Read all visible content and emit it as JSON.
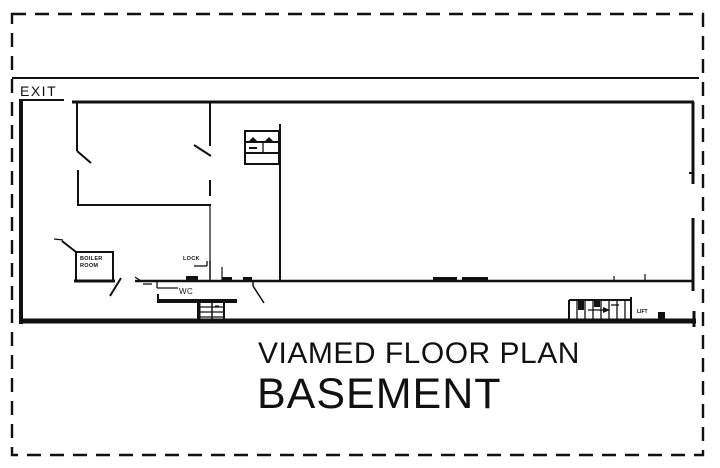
{
  "page": {
    "background": "#ffffff",
    "ink": "#111111"
  },
  "plan": {
    "exit_label": "EXIT",
    "boiler_room_label_line1": "BOILER",
    "boiler_room_label_line2": "ROOM",
    "lock_label": "LOCK",
    "wc_label": "WC",
    "lift_label": "LIFT"
  },
  "title": {
    "line1": "VIAMED FLOOR PLAN",
    "line2": "BASEMENT"
  }
}
